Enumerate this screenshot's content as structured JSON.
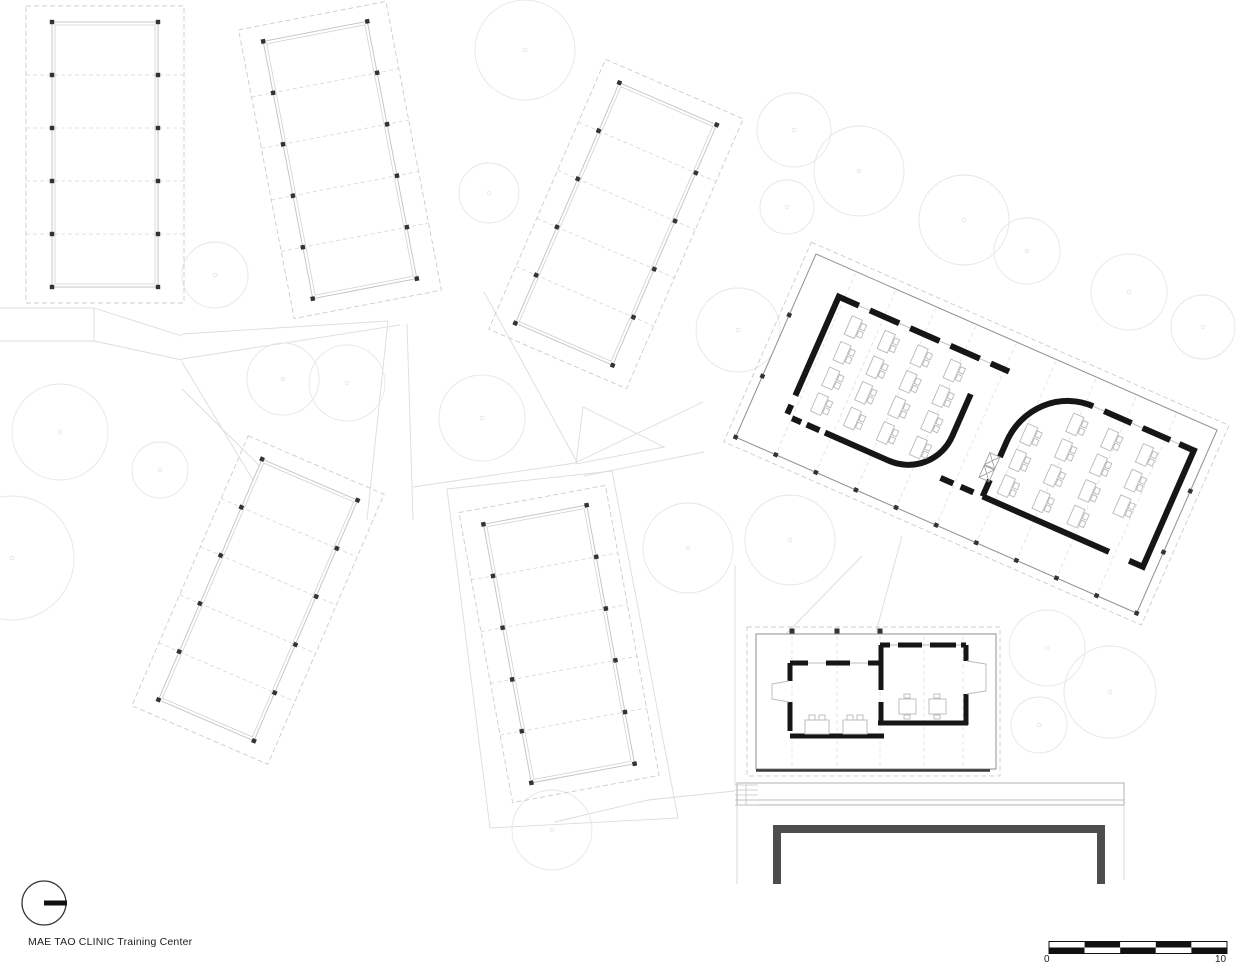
{
  "meta": {
    "title_label": "MAE TAO CLINIC Training Center"
  },
  "scale_bar": {
    "zero_label": "0",
    "ten_label": "10",
    "x": 1049,
    "y": 941.5,
    "seg_w": 35.6,
    "row_h": 6,
    "segments": 5
  },
  "north_arrow": {
    "cx": 44,
    "cy": 903,
    "r": 22,
    "bar_len": 23,
    "bar_w": 5
  },
  "colors": {
    "paper": "#ffffff",
    "wall": "#161616",
    "court_wall": "#4d4d4d",
    "tree": "#e6e6e6",
    "walkway": "#dcdcdc",
    "faint_line": "#c6c6c6",
    "faint_inner": "#d2d2d2",
    "faint_dash": "#d6d6d6",
    "site_dash": "#cccccc",
    "column_dot": "#333333",
    "main_outline": "#8f8f8f",
    "bay_dash": "#e0e0e0",
    "furniture": "#b9b9b9",
    "window": "#c9c9c9",
    "door": "#9a9a9a",
    "terrace_line": "#a8a8a8",
    "stair_line": "#c2c2c2",
    "drop_line": "#d4d4d4",
    "cut_line": "#3a3a3a",
    "text": "#1d1d1d",
    "scale_dark": "#111111"
  },
  "site": {
    "trees": [
      [
        525,
        50,
        50
      ],
      [
        489,
        193,
        30
      ],
      [
        794,
        130,
        37
      ],
      [
        859,
        171,
        45
      ],
      [
        787,
        207,
        27
      ],
      [
        964,
        220,
        45
      ],
      [
        1027,
        251,
        33
      ],
      [
        1129,
        292,
        38
      ],
      [
        1203,
        327,
        32
      ],
      [
        738,
        330,
        42
      ],
      [
        283,
        379,
        36
      ],
      [
        347,
        383,
        38
      ],
      [
        482,
        418,
        43
      ],
      [
        60,
        432,
        48
      ],
      [
        160,
        470,
        28
      ],
      [
        12,
        558,
        62
      ],
      [
        688,
        548,
        45
      ],
      [
        790,
        540,
        45
      ],
      [
        1047,
        648,
        38
      ],
      [
        1110,
        692,
        46
      ],
      [
        1039,
        725,
        28
      ],
      [
        552,
        830,
        40
      ],
      [
        215,
        275,
        33
      ]
    ],
    "walkways": [
      [
        182,
        334,
        388,
        321
      ],
      [
        182,
        359,
        400,
        325
      ],
      [
        388,
        321,
        367,
        520
      ],
      [
        407,
        324,
        413,
        520
      ],
      [
        413,
        487,
        575,
        463
      ],
      [
        484,
        292,
        577,
        462
      ],
      [
        575,
        463,
        703,
        402
      ],
      [
        584,
        476,
        704,
        452
      ],
      [
        182,
        389,
        299,
        505
      ],
      [
        182,
        362,
        268,
        505
      ],
      [
        0,
        308,
        94,
        308
      ],
      [
        94,
        308,
        94,
        341
      ],
      [
        0,
        341,
        94,
        341
      ],
      [
        94,
        308,
        182,
        336
      ],
      [
        94,
        341,
        182,
        360
      ],
      [
        862,
        556,
        786,
        634
      ],
      [
        902,
        536,
        876,
        632
      ],
      [
        735,
        565,
        735,
        785
      ],
      [
        648,
        800,
        735,
        791
      ],
      [
        555,
        822,
        648,
        800
      ]
    ],
    "polygons": [
      [
        [
          583,
          407
        ],
        [
          664,
          447
        ],
        [
          576,
          464
        ]
      ],
      [
        [
          447,
          489
        ],
        [
          612,
          471
        ],
        [
          678,
          818
        ],
        [
          490,
          828
        ]
      ]
    ]
  },
  "faint_buildings": [
    {
      "id": "dorm-a",
      "cx": 105,
      "cy": 154.5,
      "w": 106,
      "h": 265,
      "angle": 0,
      "bays": 5,
      "pad_x": 26,
      "pad_y": 16
    },
    {
      "id": "dorm-b",
      "cx": 340,
      "cy": 160,
      "w": 106,
      "h": 262,
      "angle": -10.9,
      "bays": 5,
      "pad_x": 22,
      "pad_y": 16
    },
    {
      "id": "dorm-c",
      "cx": 616,
      "cy": 224,
      "w": 106,
      "h": 262,
      "angle": 23.4,
      "bays": 5,
      "pad_x": 22,
      "pad_y": 16
    },
    {
      "id": "dorm-d",
      "cx": 258,
      "cy": 600,
      "w": 104,
      "h": 262,
      "angle": 23.3,
      "bays": 5,
      "pad_x": 22,
      "pad_y": 16
    },
    {
      "id": "dorm-e",
      "cx": 559,
      "cy": 644,
      "w": 105,
      "h": 263,
      "angle": -10.5,
      "bays": 5,
      "pad_x": 22,
      "pad_y": 16
    }
  ],
  "main_building": {
    "x": 816,
    "y": 254,
    "angle": 23.7,
    "w": 438,
    "h": 200,
    "pad": 9,
    "bays": 10,
    "wall_w": 6,
    "walls": [
      "M38,138 V30 H60",
      "M72,30 H104",
      "M116,30 H148",
      "M160,30 H192",
      "M204,30 H224",
      "M38,148 V158",
      "M44,160 H54",
      "M60,160 H74",
      "M80,160 H150 A48 48 0 0 0 198 112 V66",
      "M250,155 V137",
      "M250,112 V95 A65 67 0 0 1 315 28",
      "M327,28 H357",
      "M369,28 H399",
      "M409,28 H425 V155 H410",
      "M388,155 H250",
      "M226,155 H240",
      "M204,155 H218"
    ],
    "window_lines": [
      "M38,30 H224",
      "M315,28 H425"
    ],
    "door_x": [
      {
        "x": 239,
        "y": 112,
        "w": 11,
        "h": 13
      },
      {
        "x": 239,
        "y": 126,
        "w": 11,
        "h": 13
      }
    ],
    "desks_left": {
      "cols": [
        58,
        94,
        130,
        166
      ],
      "rows": [
        42,
        70,
        98,
        126
      ],
      "skip": []
    },
    "desks_right": {
      "cols": [
        262,
        300,
        338,
        376
      ],
      "rows": [
        42,
        70,
        98,
        126
      ],
      "skip": [
        [
          0,
          0
        ],
        [
          3,
          3
        ]
      ]
    },
    "desk": {
      "tw": 11,
      "th": 20,
      "cw": 5,
      "ch": 6
    },
    "left_room_desk_count": 16,
    "right_room_desk_count": 14
  },
  "annex": {
    "site": [
      747,
      627,
      253,
      149
    ],
    "rect": [
      756,
      634,
      240,
      135
    ],
    "wall_w": 5,
    "cut_line": [
      756,
      770.5,
      990,
      770.5
    ],
    "columns_x": [
      792,
      837,
      880
    ],
    "columns_y": 631,
    "bay_lines_x": [
      792,
      837,
      880,
      924,
      963
    ],
    "bay_y1": 636,
    "bay_y2": 767,
    "walls": [
      "M790,663 H808",
      "M826,663 H850",
      "M868,663 H883",
      "M790,663 V681",
      "M790,702 V731",
      "M790,736 H884",
      "M880,645 H890",
      "M898,645 H922",
      "M930,645 H956",
      "M961,645 H966",
      "M881,645 V690",
      "M881,702 V725",
      "M966,645 V661",
      "M966,694 V725",
      "M878,723 H968"
    ],
    "window_lines": [
      "M790,663 H883",
      "M880,645 H966"
    ],
    "door_swings": [
      "M789,681 L772,684 L772,699 L789,702",
      "M967,661 L986,664 L986,691 L967,694"
    ],
    "tables": [
      [
        805,
        720
      ],
      [
        843,
        720
      ]
    ],
    "desks": [
      [
        899,
        699
      ],
      [
        929,
        699
      ]
    ]
  },
  "terrace": {
    "rect": [
      737,
      783,
      387,
      22
    ],
    "mid_line_y": 800,
    "stairs": {
      "x": 735,
      "y": 785,
      "w": 23,
      "h": 20,
      "steps": 4,
      "mid_x": 746
    },
    "drop_lines": [
      [
        737,
        805,
        737,
        884
      ],
      [
        1124,
        805,
        1124,
        880
      ]
    ]
  },
  "court_wall": {
    "d": "M777,884 V829 H1101 V884",
    "w": 8
  }
}
